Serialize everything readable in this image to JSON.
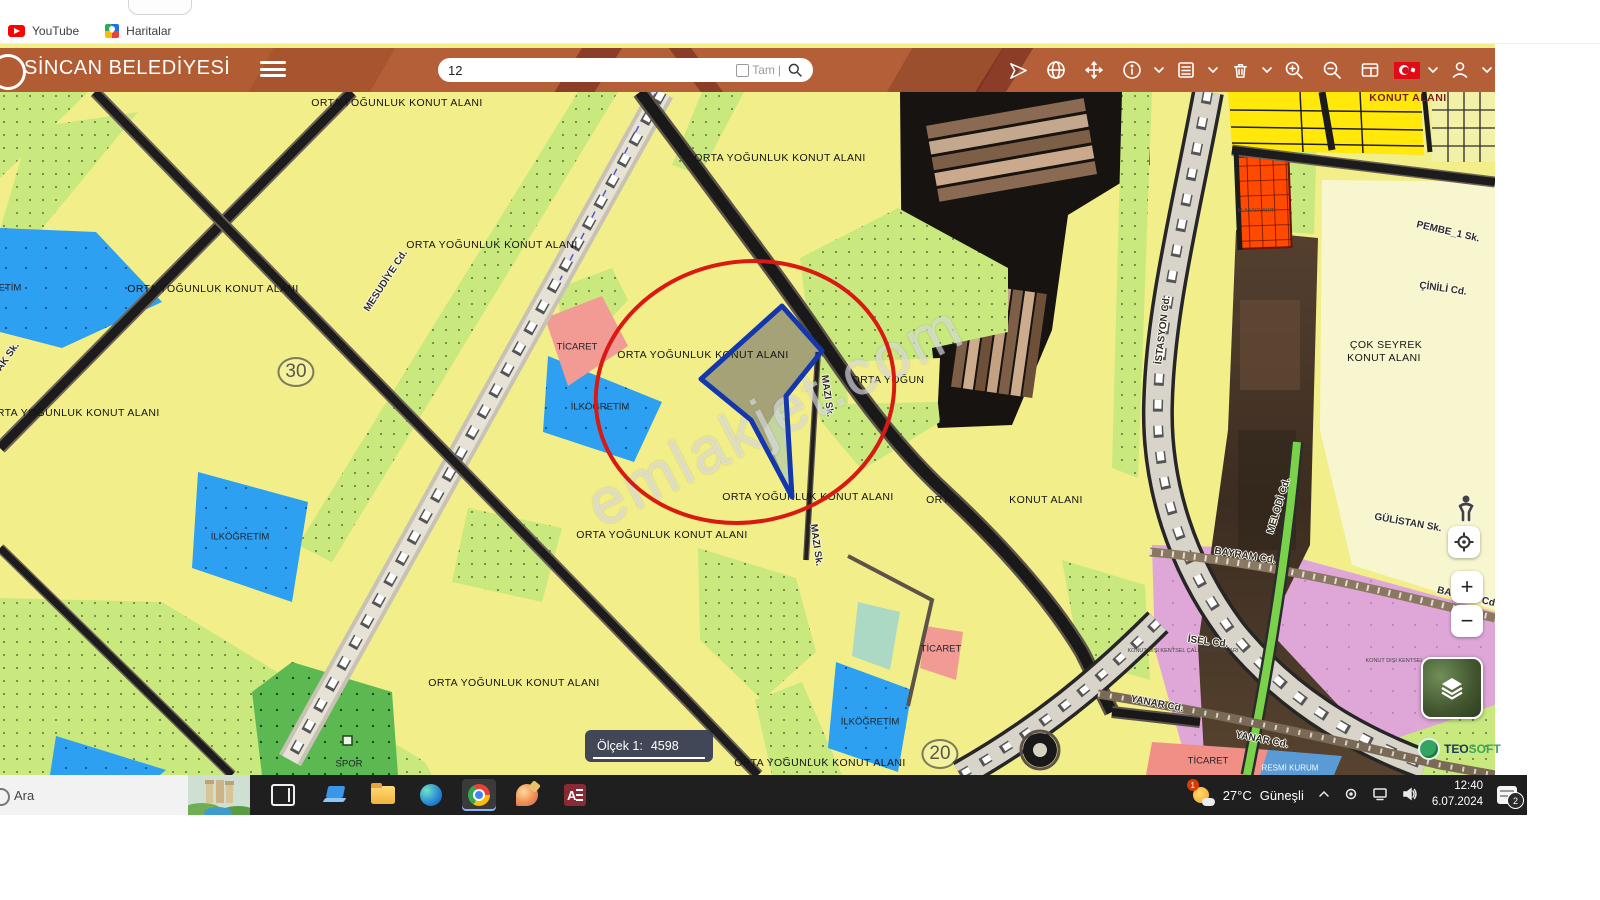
{
  "browser": {
    "bookmarks": [
      {
        "label": "YouTube",
        "icon": "youtube-icon"
      },
      {
        "label": "Haritalar",
        "icon": "google-maps-icon"
      }
    ]
  },
  "header": {
    "title": "SİNCAN BELEDİYESİ",
    "search": {
      "value": "12",
      "exact_label": "Tam"
    },
    "accent_color": "#b45f37",
    "icons": [
      "menu-icon",
      "send-icon",
      "globe-icon",
      "move-icon",
      "info-icon",
      "info-caret-icon",
      "list-icon",
      "list-caret-icon",
      "trash-icon",
      "trash-caret-icon",
      "zoom-in-icon",
      "zoom-out-icon",
      "panel-icon",
      "flag-tr-icon",
      "flag-caret-icon",
      "user-icon",
      "user-caret-icon"
    ]
  },
  "map": {
    "watermark": "emlakjet.com",
    "scale": {
      "label": "Ölçek 1:",
      "value": "4598"
    },
    "controls": {
      "zoom_in": "+",
      "zoom_out": "−",
      "logo_teo": "TEO",
      "logo_soft": "SOFT"
    },
    "colors": {
      "residential_yellow": "#f2ee8a",
      "green_area": "#c9e87e",
      "school_blue": "#2da0f2",
      "commerce_pink": "#f29b94",
      "mauve_zone": "#dfa6d8",
      "annotation_red": "#d81a12",
      "parcel_outline_blue": "#1537ad",
      "fuel_orange": "#ff4a00"
    },
    "labels": [
      {
        "t": "ORTA YOĞUNLUK KONUT ALANI",
        "x": 397,
        "y": 103,
        "r": 0,
        "c": "zone"
      },
      {
        "t": "ORTA YOĞUNLUK KONUT ALANI",
        "x": 780,
        "y": 158,
        "r": 0,
        "c": "zone"
      },
      {
        "t": "ORTA YOĞUNLUK KONUT ALANI",
        "x": 492,
        "y": 245,
        "r": 0,
        "c": "zone"
      },
      {
        "t": "ORTA YOĞUNLUK KONUT ALANI",
        "x": 213,
        "y": 289,
        "r": 0,
        "c": "zone"
      },
      {
        "t": "ORTA YOĞUNLUK KONUT ALANI",
        "x": 74,
        "y": 413,
        "r": 0,
        "c": "zone"
      },
      {
        "t": "ORTA YOĞUNLUK KONUT ALANI",
        "x": 703,
        "y": 355,
        "r": 0,
        "c": "zone"
      },
      {
        "t": "ORTA YOĞUN",
        "x": 888,
        "y": 380,
        "r": 0,
        "c": "zone"
      },
      {
        "t": "ORTA YOĞUNLUK KONUT ALANI",
        "x": 808,
        "y": 497,
        "r": 0,
        "c": "zone"
      },
      {
        "t": "ORTA YOĞUNLUK KONUT ALANI",
        "x": 662,
        "y": 535,
        "r": 0,
        "c": "zone"
      },
      {
        "t": "ORTA",
        "x": 941,
        "y": 500,
        "r": 0,
        "c": "zone"
      },
      {
        "t": "KONUT ALANI",
        "x": 1046,
        "y": 500,
        "r": 0,
        "c": "zone"
      },
      {
        "t": "ORTA YOĞUNLUK KONUT ALANI",
        "x": 514,
        "y": 683,
        "r": 0,
        "c": "zone"
      },
      {
        "t": "ORTA YOĞUNLUK KONUT ALANI",
        "x": 820,
        "y": 763,
        "r": 0,
        "c": "zone"
      },
      {
        "t": "ÇOK SEYREK",
        "x": 1386,
        "y": 345,
        "r": 0,
        "c": "zone"
      },
      {
        "t": "KONUT ALANI",
        "x": 1384,
        "y": 358,
        "r": 0,
        "c": "zone"
      },
      {
        "t": "KONUT ALANI",
        "x": 1408,
        "y": 98,
        "r": 0,
        "c": "dark"
      },
      {
        "t": "İLKÖĞRETİM",
        "x": -8,
        "y": 288,
        "r": 0,
        "c": "small"
      },
      {
        "t": "İLKÖĞRETİM",
        "x": 240,
        "y": 537,
        "r": 0,
        "c": "small"
      },
      {
        "t": "İLKÖĞRETİM",
        "x": 600,
        "y": 407,
        "r": 0,
        "c": "small"
      },
      {
        "t": "İLKÖĞRETİM",
        "x": 870,
        "y": 722,
        "r": 0,
        "c": "small"
      },
      {
        "t": "TİCARET",
        "x": 577,
        "y": 347,
        "r": 0,
        "c": "small"
      },
      {
        "t": "TİCARET",
        "x": 941,
        "y": 649,
        "r": 0,
        "c": "small"
      },
      {
        "t": "TİCARET",
        "x": 1208,
        "y": 761,
        "r": 0,
        "c": "small"
      },
      {
        "t": "RESMİ KURUM",
        "x": 1290,
        "y": 768,
        "r": 0,
        "c": "white"
      },
      {
        "t": "SPOR",
        "x": 349,
        "y": 764,
        "r": 0,
        "c": "small"
      },
      {
        "t": "M-AKARYAKIT",
        "x": 1256,
        "y": 211,
        "r": 0,
        "c": "tiny"
      },
      {
        "t": "KONUT DIŞI KENTSEL ÇALIŞMA ALANLARI",
        "x": 1183,
        "y": 651,
        "r": 0,
        "c": "tiny"
      },
      {
        "t": "KONUT DIŞI KENTSEL ÇALIŞMA ALANLARI",
        "x": 1421,
        "y": 661,
        "r": 0,
        "c": "tiny"
      },
      {
        "t": "MESUDİYE Cd.",
        "x": 386,
        "y": 281,
        "r": -57,
        "c": "street"
      },
      {
        "t": "MAZI Sk.",
        "x": 827,
        "y": 396,
        "r": 82,
        "c": "street"
      },
      {
        "t": "MAZI Sk.",
        "x": 816,
        "y": 545,
        "r": 82,
        "c": "street"
      },
      {
        "t": "İSTASYON Cd.",
        "x": 1163,
        "y": 330,
        "r": -83,
        "c": "street"
      },
      {
        "t": "MELODİ Cd.",
        "x": 1279,
        "y": 506,
        "r": -73,
        "c": "street"
      },
      {
        "t": "BAYRAM Cd.",
        "x": 1245,
        "y": 556,
        "r": 9,
        "c": "street"
      },
      {
        "t": "BAYRAM Cd",
        "x": 1466,
        "y": 597,
        "r": 13,
        "c": "street"
      },
      {
        "t": "İSEL Cd.",
        "x": 1208,
        "y": 642,
        "r": 7,
        "c": "street"
      },
      {
        "t": "YANAR Cd.",
        "x": 1157,
        "y": 704,
        "r": 11,
        "c": "street"
      },
      {
        "t": "YANAR Cd.",
        "x": 1262,
        "y": 740,
        "r": 11,
        "c": "street"
      },
      {
        "t": "GÜLİSTAN Sk.",
        "x": 1408,
        "y": 523,
        "r": 10,
        "c": "street"
      },
      {
        "t": "PEMBE_1 Sk.",
        "x": 1448,
        "y": 232,
        "r": 13,
        "c": "street"
      },
      {
        "t": "ÇİNİLİ Cd.",
        "x": 1443,
        "y": 289,
        "r": 8,
        "c": "street"
      },
      {
        "t": "AK Sk.",
        "x": 8,
        "y": 357,
        "r": -55,
        "c": "street"
      },
      {
        "t": "30",
        "x": 296,
        "y": 372,
        "r": 0,
        "c": "circled"
      },
      {
        "t": "20",
        "x": 940,
        "y": 754,
        "r": 0,
        "c": "circled"
      }
    ]
  },
  "taskbar": {
    "search_label": "Ara",
    "apps": [
      "task-view",
      "pc-app",
      "file-explorer",
      "edge",
      "chrome",
      "paint-3d",
      "access"
    ],
    "active_app": "chrome",
    "tray": {
      "weather_badge": "1",
      "temperature": "27°C",
      "condition": "Güneşli",
      "time": "12:40",
      "date": "6.07.2024",
      "notification_badge": "2"
    }
  }
}
